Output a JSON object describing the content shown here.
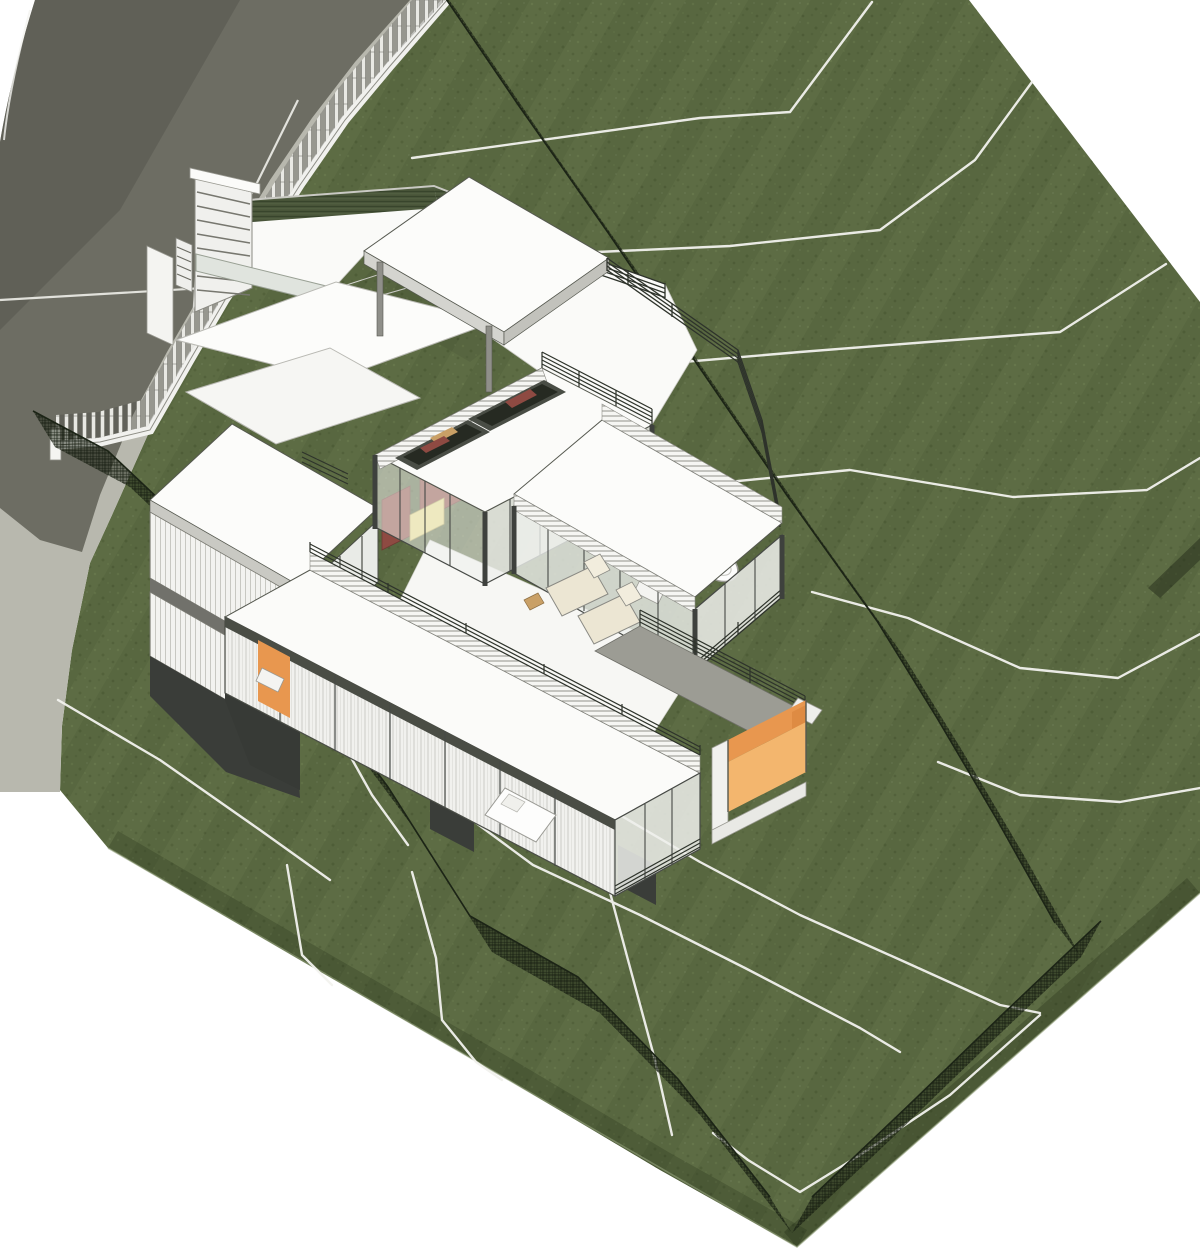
{
  "scene": {
    "title": "Aerial axonometric render of a split-level hillside house on a sloping grass lot",
    "view_label": "3D site view",
    "background_color": "#ffffff"
  },
  "palette": {
    "grass": "#5d6c44",
    "grass_shadow": "#4e5d38",
    "terrain_edge": "#43502f",
    "road_asphalt": "#6d6d63",
    "road_verge": "#b8b8ae",
    "contour_line": "#f2f2ee",
    "mesh_fence": "#1f2818",
    "wall_white": "#fbfbf9",
    "fascia_gray": "#c9c9c3",
    "frame_dark": "#3e413d",
    "glass": "#eef0ec",
    "deck_gray": "#9c9c94",
    "accent_orange": "#e8974f",
    "accent_orange_light": "#f3b66e",
    "accent_orange_door": "#e0823f",
    "sofa_maroon": "#8e4a42",
    "table_yellow": "#eee08a",
    "wood_tan": "#c9a066",
    "lounger_cream": "#ece6d3",
    "hedge_green": "#49563a"
  },
  "site": {
    "terrain_label": "sloped grass lot with mowing texture",
    "road_label": "curved street with light verge",
    "contour_line_count": 16,
    "fences": {
      "street_fence_label": "white picket fence on street wall",
      "northeast_fence_label": "dark mesh boundary fence (northeast)",
      "southwest_fence_label": "dark mesh boundary fence (southwest)",
      "southeast_fence_label": "dark mesh boundary fence (southeast corner)"
    },
    "hedge_label": "clipped hedge beside entry court",
    "gate_label": "louvered entry gate and side door"
  },
  "house": {
    "blocks": [
      {
        "label": "entry court with floating carport roof"
      },
      {
        "label": "two-storey white-clad bedroom block"
      },
      {
        "label": "glazed living pavilion with two roof-deck skylight openings"
      },
      {
        "label": "single-storey bathroom wing"
      },
      {
        "label": "long cantilevered sleeping wing with roof terrace"
      },
      {
        "label": "orange-lined entry tunnel under grey deck"
      }
    ],
    "details": [
      "cable railings on all roof decks",
      "floor-to-ceiling glazing with dark mullions",
      "white louvre parapets",
      "spiral stair",
      "dark support piers on the slope"
    ]
  },
  "furniture": [
    {
      "label": "maroon sofas in living room"
    },
    {
      "label": "yellow coffee table"
    },
    {
      "label": "timber bar stools"
    },
    {
      "label": "two cream sun loungers on terrace"
    },
    {
      "label": "double bed in sleeping wing"
    },
    {
      "label": "oval bathtub in bathroom wing"
    },
    {
      "label": "desk with orange feature wall"
    }
  ]
}
